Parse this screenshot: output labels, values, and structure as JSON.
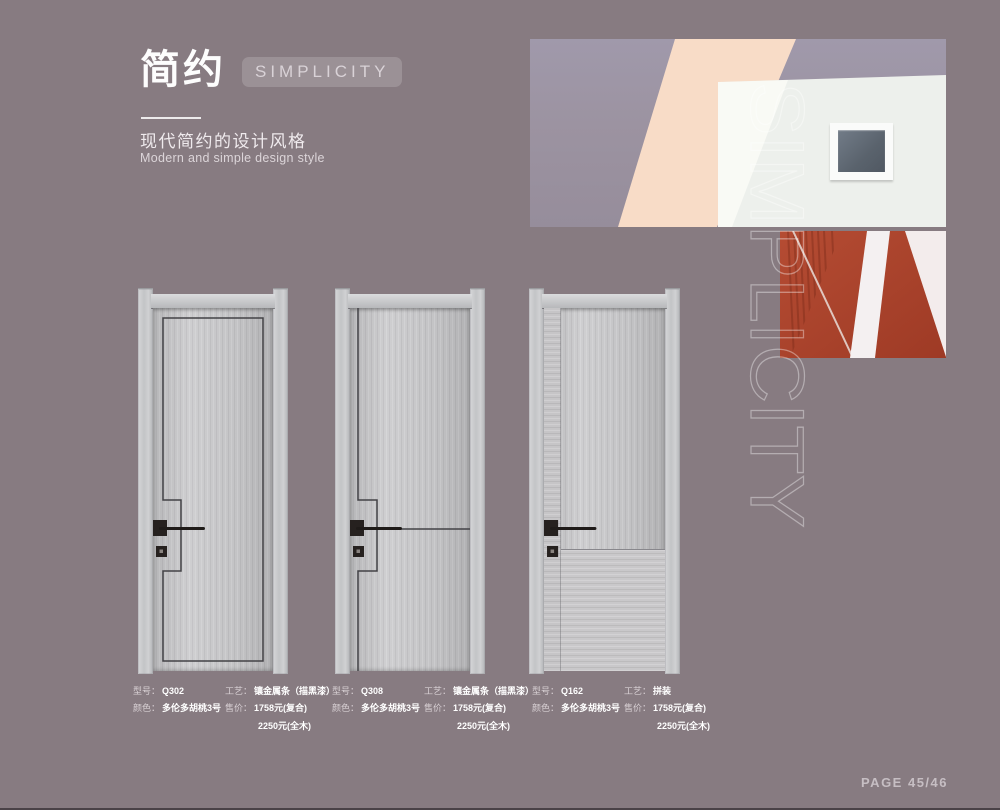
{
  "page": {
    "background": "#877b81",
    "page_number": "PAGE 45/46"
  },
  "header": {
    "title_cn": "简约",
    "title_en": "SIMPLICITY",
    "subtitle_cn": "现代简约的设计风格",
    "subtitle_en": "Modern and simple design style"
  },
  "watermark": {
    "text": "SIMPLICITY"
  },
  "hero": {
    "photo_main": "white-building-corner-with-square-window-peach-stripe",
    "photo_detail": "red-wall-with-white-beams",
    "colors": {
      "wall_gray": "#9c93a1",
      "peach": "#f8dcc7",
      "wall_white": "#edf0ec",
      "red": "#ad4930"
    }
  },
  "products": [
    {
      "model_label": "型号：",
      "model": "Q302",
      "craft_label": "工艺：",
      "craft": "镶金属条（描黑漆）",
      "color_label": "颜色：",
      "color": "多伦多胡桃3号",
      "price_label": "售价：",
      "price_composite": "1758元(复合)",
      "price_solid": "2250元(全木)"
    },
    {
      "model_label": "型号：",
      "model": "Q308",
      "craft_label": "工艺：",
      "craft": "镶金属条（描黑漆）",
      "color_label": "颜色：",
      "color": "多伦多胡桃3号",
      "price_label": "售价：",
      "price_composite": "1758元(复合)",
      "price_solid": "2250元(全木)"
    },
    {
      "model_label": "型号：",
      "model": "Q162",
      "craft_label": "工艺：",
      "craft": "拼装",
      "color_label": "颜色：",
      "color": "多伦多胡桃3号",
      "price_label": "售价：",
      "price_composite": "1758元(复合)",
      "price_solid": "2250元(全木)"
    }
  ]
}
